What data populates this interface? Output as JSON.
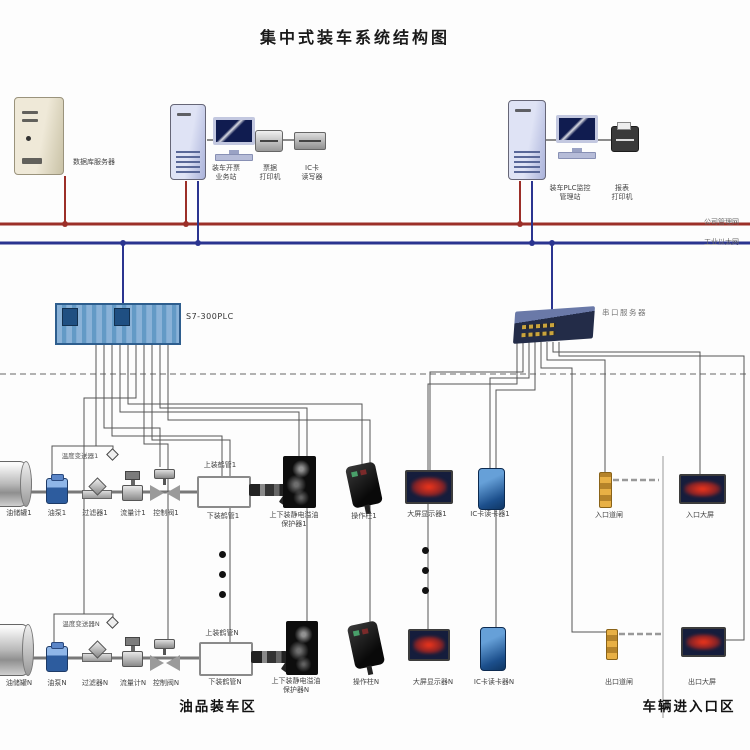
{
  "title": "集中式装车系统结构图",
  "colors": {
    "company_lan": "#9c2f28",
    "industrial_ethernet": "#2a3490"
  },
  "network": {
    "company_lan_label": "公司管理网",
    "industrial_ethernet_label": "工业以太网"
  },
  "top": {
    "database_server": "数据库服务器",
    "ticketing_station": "装车开票\n业务站",
    "ticket_printer": "票据\n打印机",
    "ic_card_writer": "IC卡\n读写器",
    "plc_monitor_station": "装车PLC监控\n管理站",
    "report_printer": "报表\n打印机"
  },
  "controllers": {
    "plc": "S7-300PLC",
    "serial_server": "串口服务器"
  },
  "lane1": {
    "tank": "油储罐1",
    "pump": "油泵1",
    "filter": "过滤器1",
    "flow_meter": "流量计1",
    "control_valve": "控制阀1",
    "temp_transmitter": "温度变送器1",
    "top_arm": "上装鹤管1",
    "bottom_arm": "下装鹤管1",
    "static_protector": "上下装静电溢油\n保护器1",
    "op_column": "操作柱1",
    "big_display": "大屏显示器1",
    "card_reader": "IC卡读卡器1",
    "gate": "入口道闸",
    "gate_display": "入口大屏"
  },
  "laneN": {
    "tank": "油储罐N",
    "pump": "油泵N",
    "filter": "过滤器N",
    "flow_meter": "流量计N",
    "control_valve": "控制阀N",
    "temp_transmitter": "温度变送器N",
    "top_arm": "上装鹤管N",
    "bottom_arm": "下装鹤管N",
    "static_protector": "上下装静电溢油\n保护器N",
    "op_column": "操作柱N",
    "big_display": "大屏显示器N",
    "card_reader": "IC卡读卡器N",
    "gate": "出口道闸",
    "gate_display": "出口大屏"
  },
  "zones": {
    "loading": "油品装车区",
    "vehicle_entry": "车辆进入口区"
  }
}
